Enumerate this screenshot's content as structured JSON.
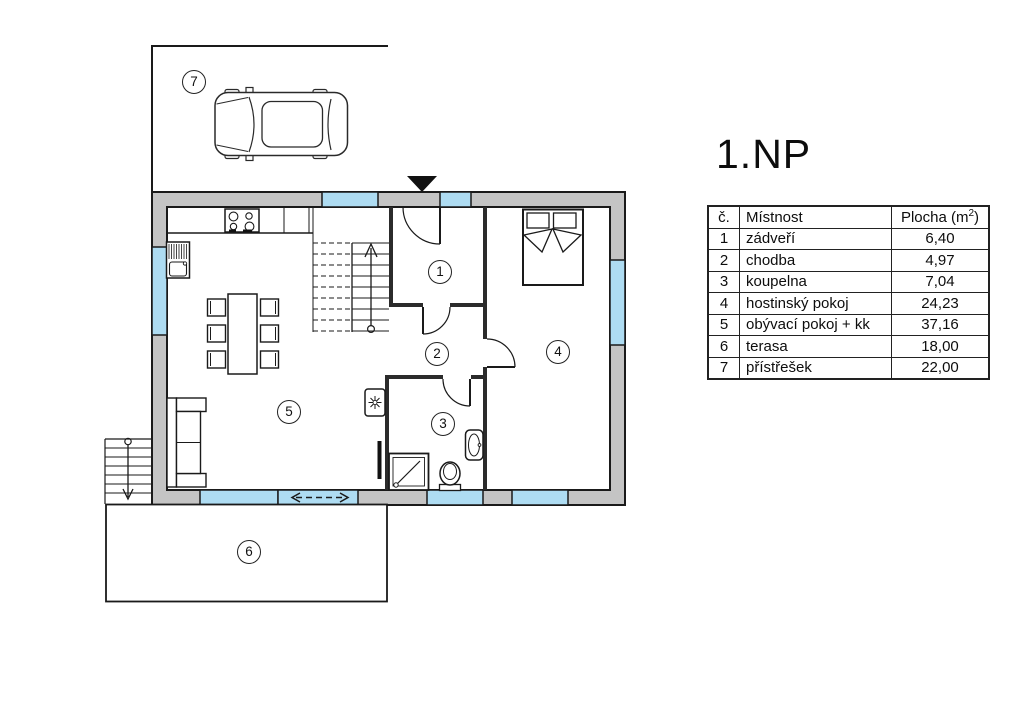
{
  "title": "1.NP",
  "table": {
    "headers": {
      "number": "č.",
      "room": "Místnost",
      "area_prefix": "Plocha (m",
      "area_sup": "2",
      "area_suffix": ")"
    }
  },
  "rooms": [
    {
      "number": "1",
      "name": "zádveří",
      "area": "6,40"
    },
    {
      "number": "2",
      "name": "chodba",
      "area": "4,97"
    },
    {
      "number": "3",
      "name": "koupelna",
      "area": "7,04"
    },
    {
      "number": "4",
      "name": "hostinský pokoj",
      "area": "24,23"
    },
    {
      "number": "5",
      "name": "obývací pokoj + kk",
      "area": "37,16"
    },
    {
      "number": "6",
      "name": "terasa",
      "area": "18,00"
    },
    {
      "number": "7",
      "name": "přístřešek",
      "area": "22,00"
    }
  ],
  "colors": {
    "wall_fill": "#c4c4c4",
    "window_fill": "#aedcf2",
    "line": "#1a1a1a",
    "background": "#ffffff"
  }
}
